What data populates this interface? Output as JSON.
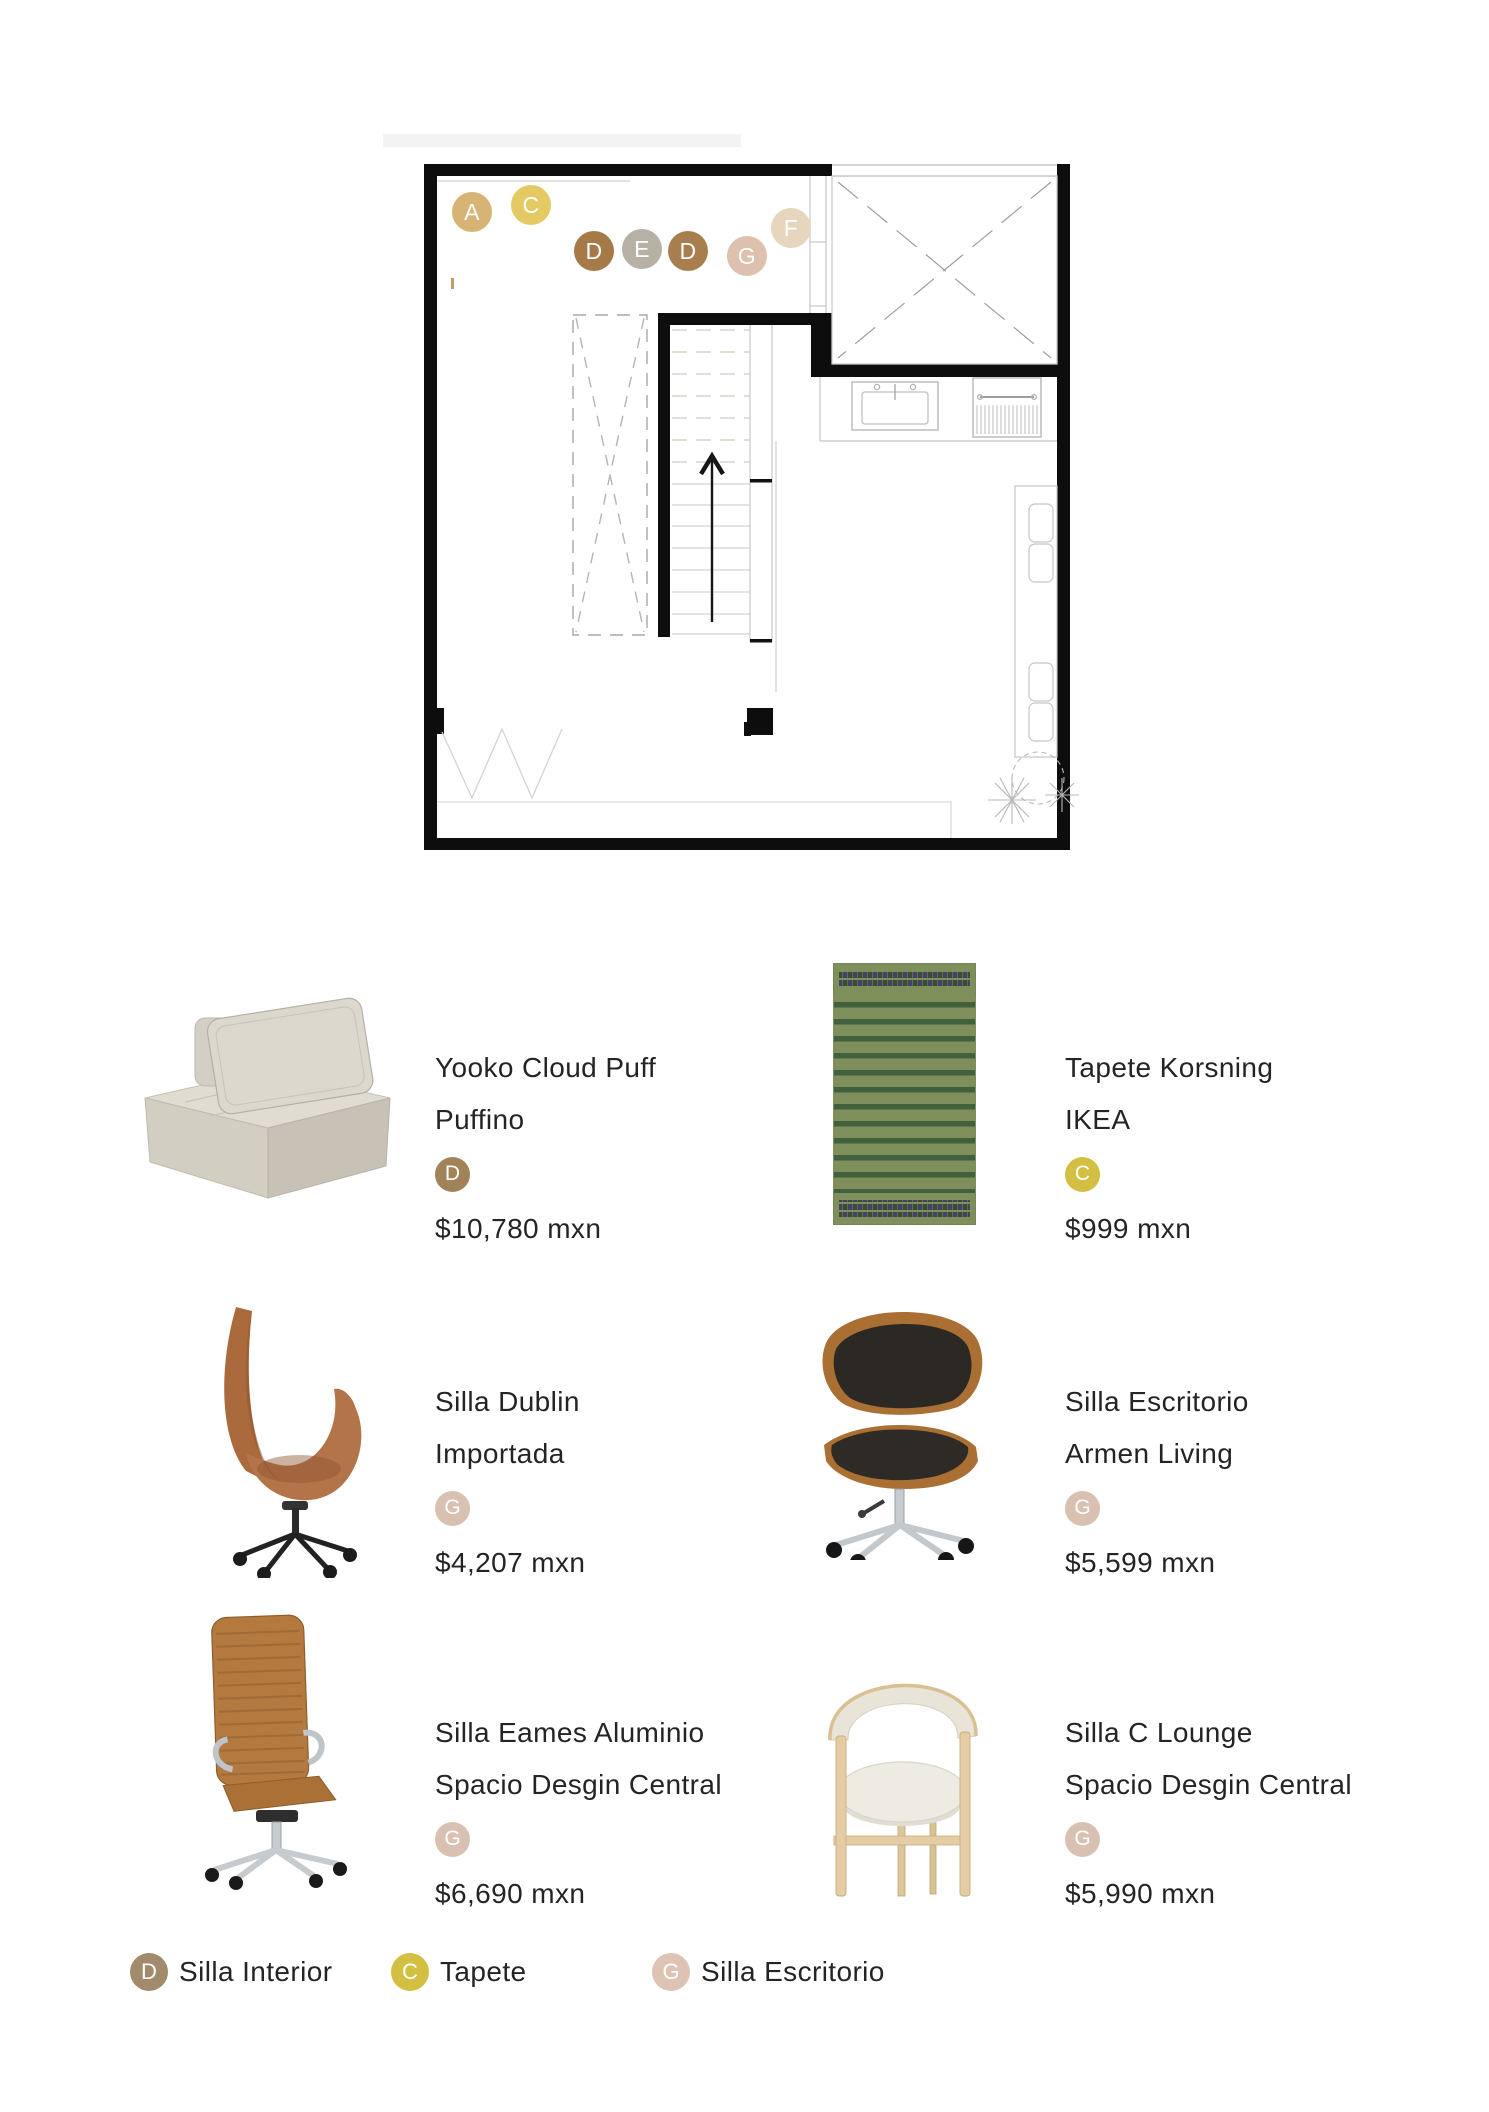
{
  "floor_plan": {
    "markers": [
      {
        "label": "A",
        "color": "#d8b376"
      },
      {
        "label": "C",
        "color": "#e5c963"
      },
      {
        "label": "D",
        "color": "#a57a48"
      },
      {
        "label": "E",
        "color": "#b7b0a4"
      },
      {
        "label": "D",
        "color": "#a87e4e"
      },
      {
        "label": "G",
        "color": "#ddc0ae"
      },
      {
        "label": "F",
        "color": "#e7d6bd"
      }
    ]
  },
  "products": [
    {
      "name": "Yooko Cloud Puff",
      "brand": "Puffino",
      "badge": "D",
      "badge_color": "#a28257",
      "price": "$10,780 mxn",
      "image": "puff-lounge-chair"
    },
    {
      "name": "Tapete Korsning",
      "brand": "IKEA",
      "badge": "C",
      "badge_color": "#d3c043",
      "price": "$999 mxn",
      "image": "green-striped-rug"
    },
    {
      "name": "Silla Dublin",
      "brand": "Importada",
      "badge": "G",
      "badge_color": "#d9c1b1",
      "price": "$4,207 mxn",
      "image": "cognac-swivel-chair"
    },
    {
      "name": "Silla Escritorio",
      "brand": "Armen Living",
      "badge": "G",
      "badge_color": "#d9c1b1",
      "price": "$5,599 mxn",
      "image": "walnut-black-office-chair"
    },
    {
      "name": "Silla Eames Aluminio",
      "brand": "Spacio Desgin Central",
      "badge": "G",
      "badge_color": "#d9c1b1",
      "price": "$6,690 mxn",
      "image": "tan-highback-office-chair"
    },
    {
      "name": "Silla C Lounge",
      "brand": "Spacio Desgin Central",
      "badge": "G",
      "badge_color": "#d9c1b1",
      "price": "$5,990 mxn",
      "image": "oak-cream-lounge-chair"
    }
  ],
  "legend": [
    {
      "label": "D",
      "text": "Silla Interior",
      "color": "#a28a6c"
    },
    {
      "label": "C",
      "text": "Tapete",
      "color": "#d3c043"
    },
    {
      "label": "G",
      "text": "Silla Escritorio",
      "color": "#dcc3b3"
    }
  ]
}
